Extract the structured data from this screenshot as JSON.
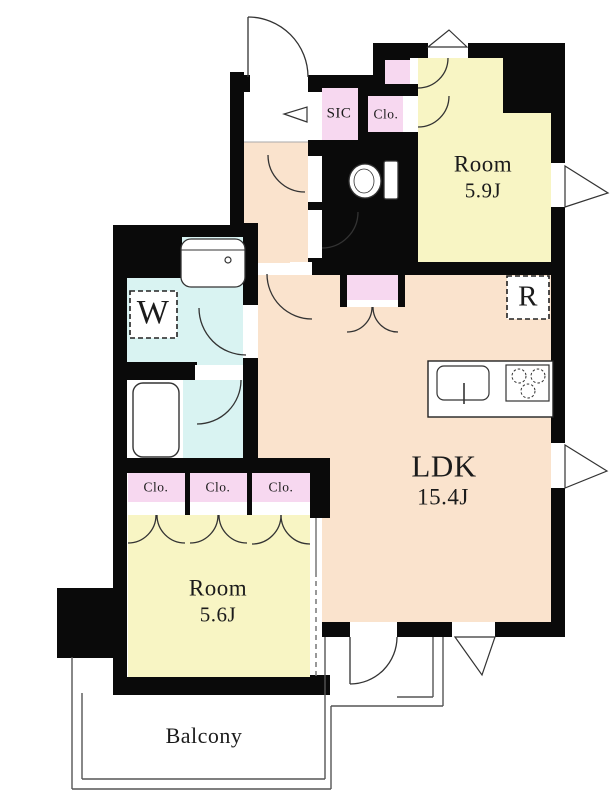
{
  "floorplan": {
    "units": {
      "room_upper": {
        "name": "Room",
        "size": "5.9J"
      },
      "ldk": {
        "name": "LDK",
        "size": "15.4J"
      },
      "room_lower": {
        "name": "Room",
        "size": "5.6J"
      },
      "balcony_label": "Balcony",
      "shoe_closet_label": "SIC",
      "closet_upper_label": "Clo.",
      "closets_row": [
        "Clo.",
        "Clo.",
        "Clo."
      ],
      "washing_machine_label": "W",
      "refrigerator_label": "R"
    },
    "colors": {
      "wall": "#0a0a0a",
      "room_yellow": "#f8f5c4",
      "ldk_peach": "#fae3cd",
      "closet_pink": "#f7d8f0",
      "wet_area_cyan": "#d9f3f2",
      "outline_line": "#333333",
      "balcony_line": "#555555"
    }
  }
}
